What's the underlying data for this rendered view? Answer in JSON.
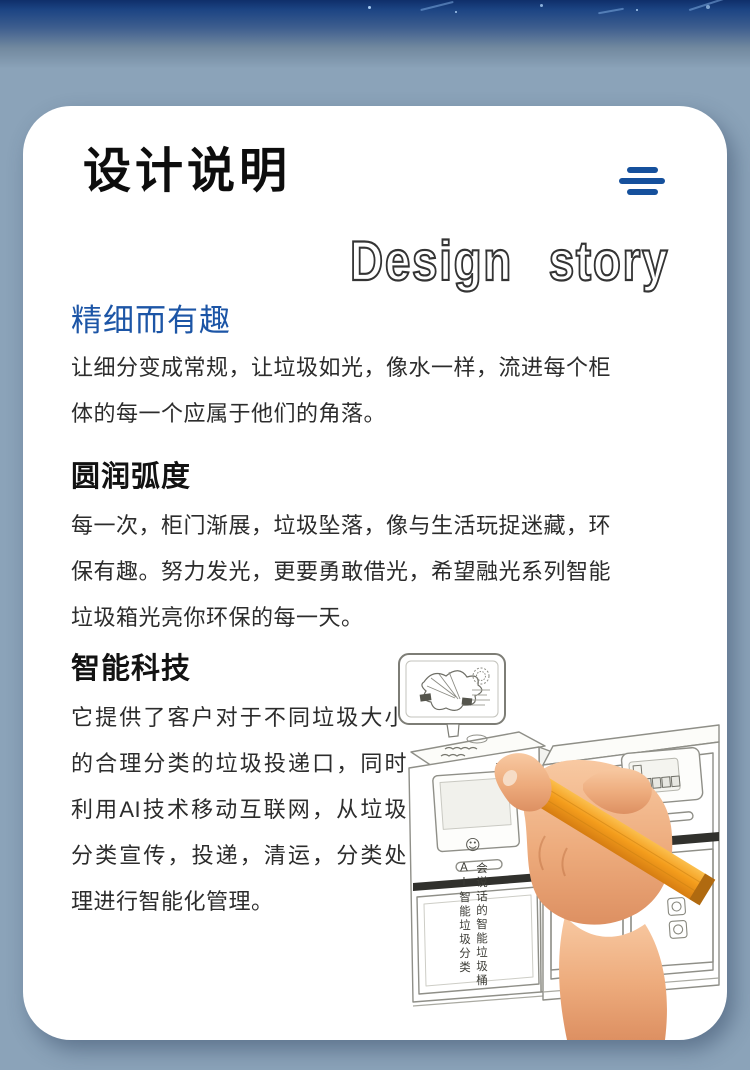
{
  "header": {
    "title": "设计说明",
    "subtitle": "Design story",
    "menu_icon": "hamburger-menu"
  },
  "sections": [
    {
      "heading": "精细而有趣",
      "body": "让细分变成常规，让垃圾如光，像水一样，流进每个柜体的每一个应属于他们的角落。"
    },
    {
      "heading": "圆润弧度",
      "body": "每一次，柜门渐展，垃圾坠落，像与生活玩捉迷藏，环保有趣。努力发光，更要勇敢借光，希望融光系列智能垃圾箱光亮你环保的每一天。"
    },
    {
      "heading": "智能科技",
      "body": "它提供了客户对于不同垃圾大小的合理分类的垃圾投递口，同时利用AI技术移动互联网，从垃圾分类宣传，投递，清运，分类处理进行智能化管理。"
    }
  ],
  "illustration": {
    "smiley_icon": "☺",
    "bin_label_right": "会说话的智能垃圾桶",
    "bin_label_left": "AI智能垃圾分类"
  },
  "colors": {
    "accent_blue": "#15509c",
    "heading_blue": "#1c55a6",
    "background_steel_blue": "#8ba3b9",
    "top_band_navy": "#0f2f6a",
    "pencil_orange": "#f49d1c",
    "card_white": "#ffffff"
  }
}
